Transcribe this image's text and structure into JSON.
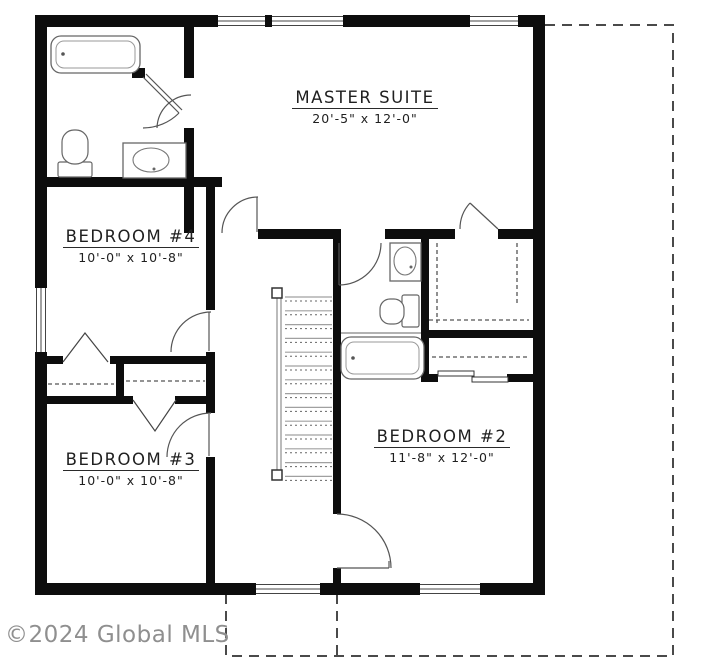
{
  "watermark": "©2024 Global MLS",
  "rooms": {
    "master_suite": {
      "name": "MASTER SUITE",
      "dims": "20'-5\" x 12'-0\""
    },
    "bedroom_4": {
      "name": "BEDROOM #4",
      "dims": "10'-0\" x 10'-8\""
    },
    "bedroom_3": {
      "name": "BEDROOM #3",
      "dims": "10'-0\" x 10'-8\""
    },
    "bedroom_2": {
      "name": "BEDROOM #2",
      "dims": "11'-8\" x 12'-0\""
    }
  },
  "colors": {
    "wall": "#0d0d0d",
    "annotation": "#555555",
    "watermark_gray": "#8f8f8f"
  },
  "legend": {
    "dashed_outline": "first-floor footprint below",
    "fixtures": [
      "bathtub",
      "toilet",
      "vanity-sink",
      "staircase",
      "closet-rod"
    ]
  }
}
